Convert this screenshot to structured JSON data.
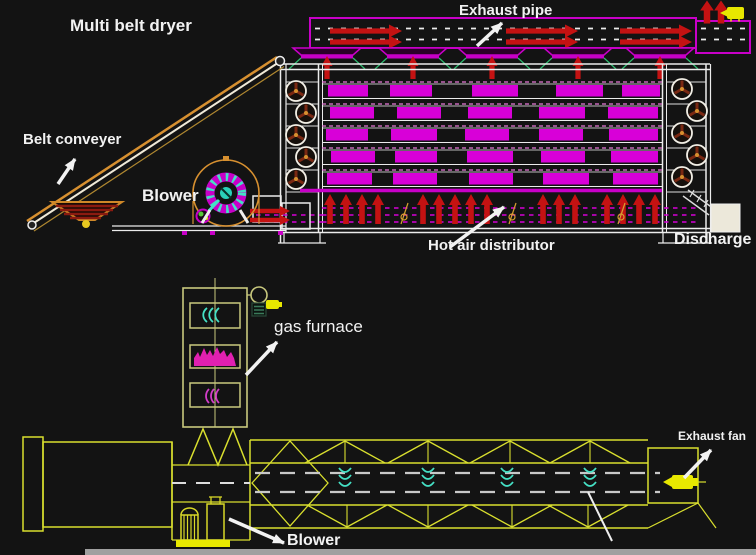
{
  "diagram": {
    "title": "Multi belt dryer",
    "annotations": {
      "exhaust_pipe": "Exhaust pipe",
      "belt_conveyer": "Belt conveyer",
      "blower_top": "Blower",
      "hot_air_distributor": "Hot air distributor",
      "discharge": "Discharge",
      "gas_furnace": "gas furnace",
      "exhaust_fan": "Exhaust fan",
      "blower_bottom": "Blower"
    },
    "structure": {
      "belt_levels": 5,
      "exhaust_funnels": 5,
      "drum_truss_bays": 4
    },
    "colors": {
      "background": "#131313",
      "magenta": "#c800c8",
      "belt_fill": "#d800d8",
      "rail_pink": "#e878d8",
      "red": "#c41212",
      "white": "#ececec",
      "yellow": "#e8e800",
      "furnace_khaki": "#c9c97e",
      "drum_lime": "#d9df2e",
      "cyan": "#45e0c5",
      "green": "#2fbd71",
      "conveyor_orange": "#d79030",
      "roller_spoke": "#7a2812",
      "discharge_cream": "#ece8da",
      "footer_gray": "#a0a0a0"
    }
  }
}
